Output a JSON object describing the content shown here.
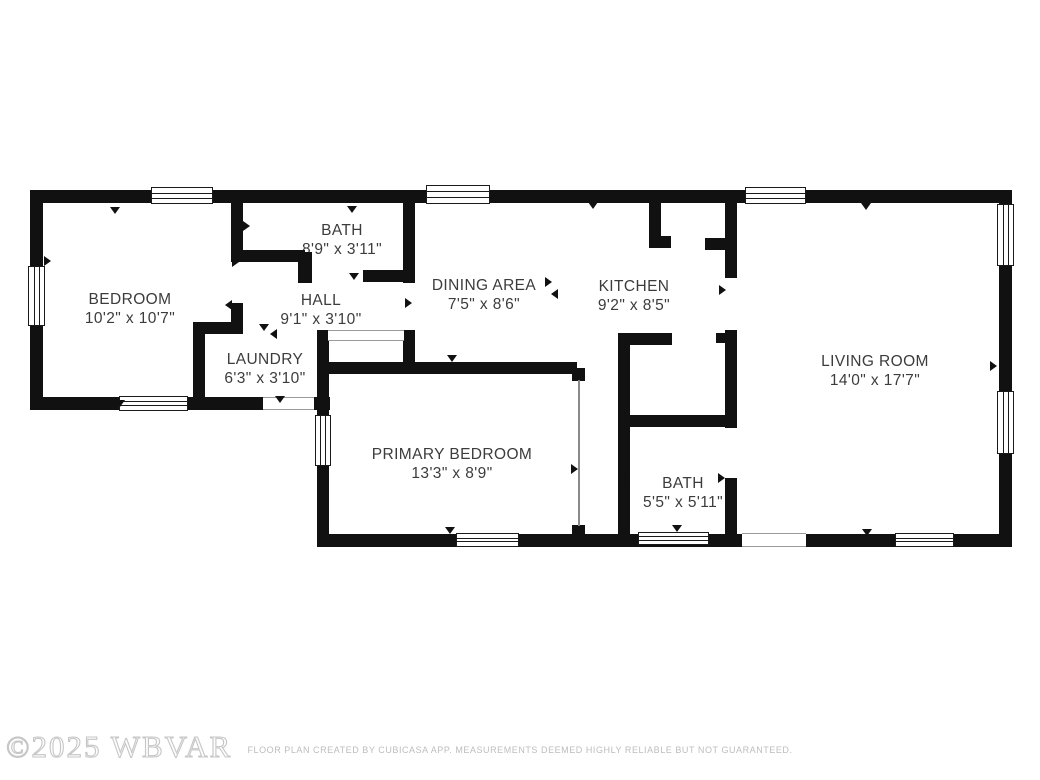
{
  "page": {
    "background": "#ffffff"
  },
  "watermark": {
    "text": "©2025 WBVAR"
  },
  "footer": {
    "disclaimer": "FLOOR PLAN CREATED BY CUBICASA APP. MEASUREMENTS DEEMED HIGHLY RELIABLE BUT NOT GUARANTEED."
  },
  "rooms": [
    {
      "id": "bedroom",
      "name": "BEDROOM",
      "dims": "10'2\" x 10'7\""
    },
    {
      "id": "bath-upper",
      "name": "BATH",
      "dims": "8'9\" x 3'11\""
    },
    {
      "id": "hall",
      "name": "HALL",
      "dims": "9'1\" x 3'10\""
    },
    {
      "id": "laundry",
      "name": "LAUNDRY",
      "dims": "6'3\" x 3'10\""
    },
    {
      "id": "dining-area",
      "name": "DINING AREA",
      "dims": "7'5\" x 8'6\""
    },
    {
      "id": "kitchen",
      "name": "KITCHEN",
      "dims": "9'2\" x 8'5\""
    },
    {
      "id": "living-room",
      "name": "LIVING ROOM",
      "dims": "14'0\" x 17'7\""
    },
    {
      "id": "primary-bedroom",
      "name": "PRIMARY BEDROOM",
      "dims": "13'3\" x 8'9\""
    },
    {
      "id": "bath-lower",
      "name": "BATH",
      "dims": "5'5\" x 5'11\""
    }
  ],
  "colors": {
    "wall": "#111111",
    "label": "#3c3c3c",
    "footer_text": "#bdbdbd",
    "watermark_outline": "#c6c6c6"
  }
}
